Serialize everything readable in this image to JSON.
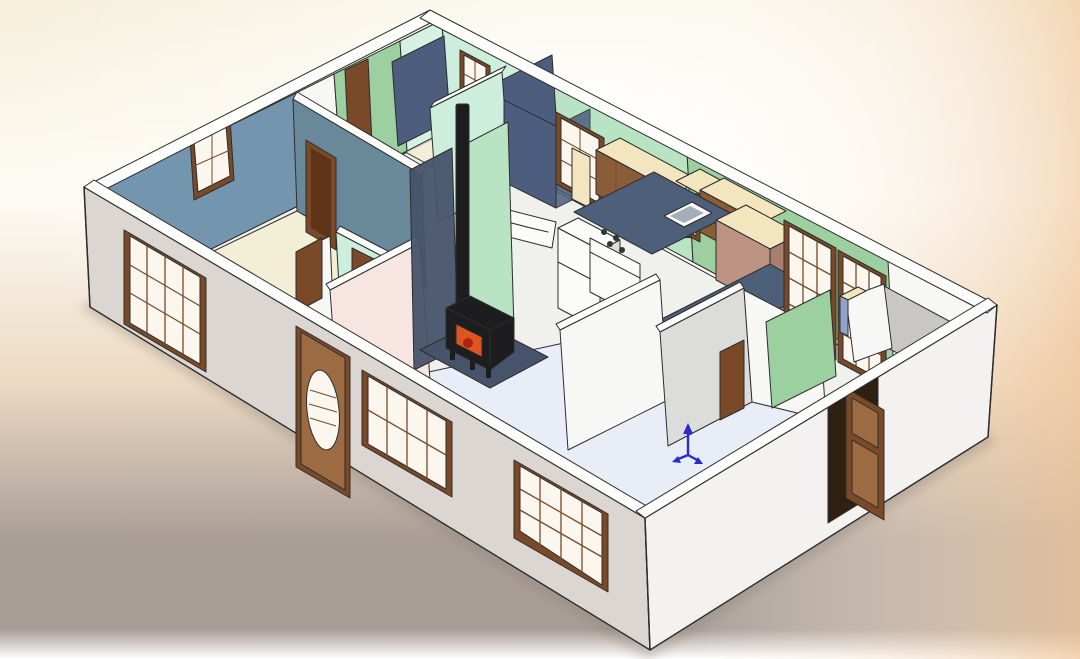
{
  "window_title": "",
  "visible_text": [],
  "scene": {
    "type": "3d-isometric-cutaway-house-floorplan",
    "view": "axonometric top-down cutaway, no roof, CAD shaded-with-edges style",
    "rooms": [
      {
        "name": "master-bedroom",
        "wall_color_key": "int_blue",
        "floor_color_key": "floor_cream"
      },
      {
        "name": "hallway",
        "wall_color_key": "int_mint"
      },
      {
        "name": "second-bedroom",
        "wall_color_key": "int_green_light",
        "closet_color_key": "int_navy"
      },
      {
        "name": "bathroom",
        "wall_color_key": "int_white",
        "shower_color_key": "int_navy"
      },
      {
        "name": "kitchen",
        "wall_color_key": "int_green"
      },
      {
        "name": "dining-area",
        "wall_color_key": "int_green"
      },
      {
        "name": "living-room",
        "wall_color_key": "int_pink",
        "floor_color_key": "floor_living"
      },
      {
        "name": "entry-hall",
        "wall_color_key": "int_gray_light"
      },
      {
        "name": "utility-room",
        "wall_color_key": "int_gray"
      }
    ],
    "objects": [
      "wood-stove",
      "stove-pipe",
      "hearth-pad",
      "chimney-brick-panel",
      "refrigerator",
      "range",
      "range-hood",
      "kitchen-sink",
      "upper-cabinets",
      "tile-countertop",
      "slate-countertop",
      "breakfast-bar",
      "bathtub",
      "shower-surround",
      "glass-panel-door",
      "front-door-oval-glass",
      "open-side-door",
      "french-doors",
      "grid-sash-windows",
      "origin-triad"
    ]
  },
  "colors": {
    "bg_cream": "#f6efda",
    "bg_white": "#fdfbf4",
    "bg_sand": "#ecd9c2",
    "bg_mauve": "#a99e97",
    "bg_fade_white": "#ffffff",
    "bg_peach": "#f0c89d",
    "outline": "#2d2d2d",
    "wall_top": "#fdfdfc",
    "ext_sw": "#dcd6d3",
    "ext_se": "#f4f2f0",
    "int_blue": "#7396ae",
    "int_teal": "#69889a",
    "int_mint": "#cdeedd",
    "int_green": "#9cd0a0",
    "int_green_light": "#b9e4c4",
    "int_cyan_pale": "#d4f1e4",
    "int_navy": "#4d5d7d",
    "int_pink": "#f7e5e1",
    "int_white": "#f7f7f5",
    "int_gray": "#c9c7c5",
    "int_gray_light": "#dcdcda",
    "floor_base": "#f0f0ed",
    "floor_cream": "#f3eed6",
    "floor_living": "#e9edf7",
    "wood": "#7a4a28",
    "wood_dark": "#5e3317",
    "wood_light": "#9c6b42",
    "pane": "#fbf7ee",
    "slate_counter": "#4e5f79",
    "tile_cream": "#f3e5bd",
    "cabinet": "#8a5c38",
    "cabinet_dark": "#6f4827",
    "bar_mauve": "#bd9383",
    "bar_mauve_dark": "#a87e6e",
    "appliance": "#fbfbf9",
    "hearth": "#47536a",
    "stove_black": "#1d1d20",
    "fire_orange": "#e05420",
    "triad_blue": "#2a2ad4",
    "shadow": "#8d7f76"
  },
  "triad": {
    "meaning": "origin-axis-indicator",
    "color_key": "triad_blue"
  }
}
